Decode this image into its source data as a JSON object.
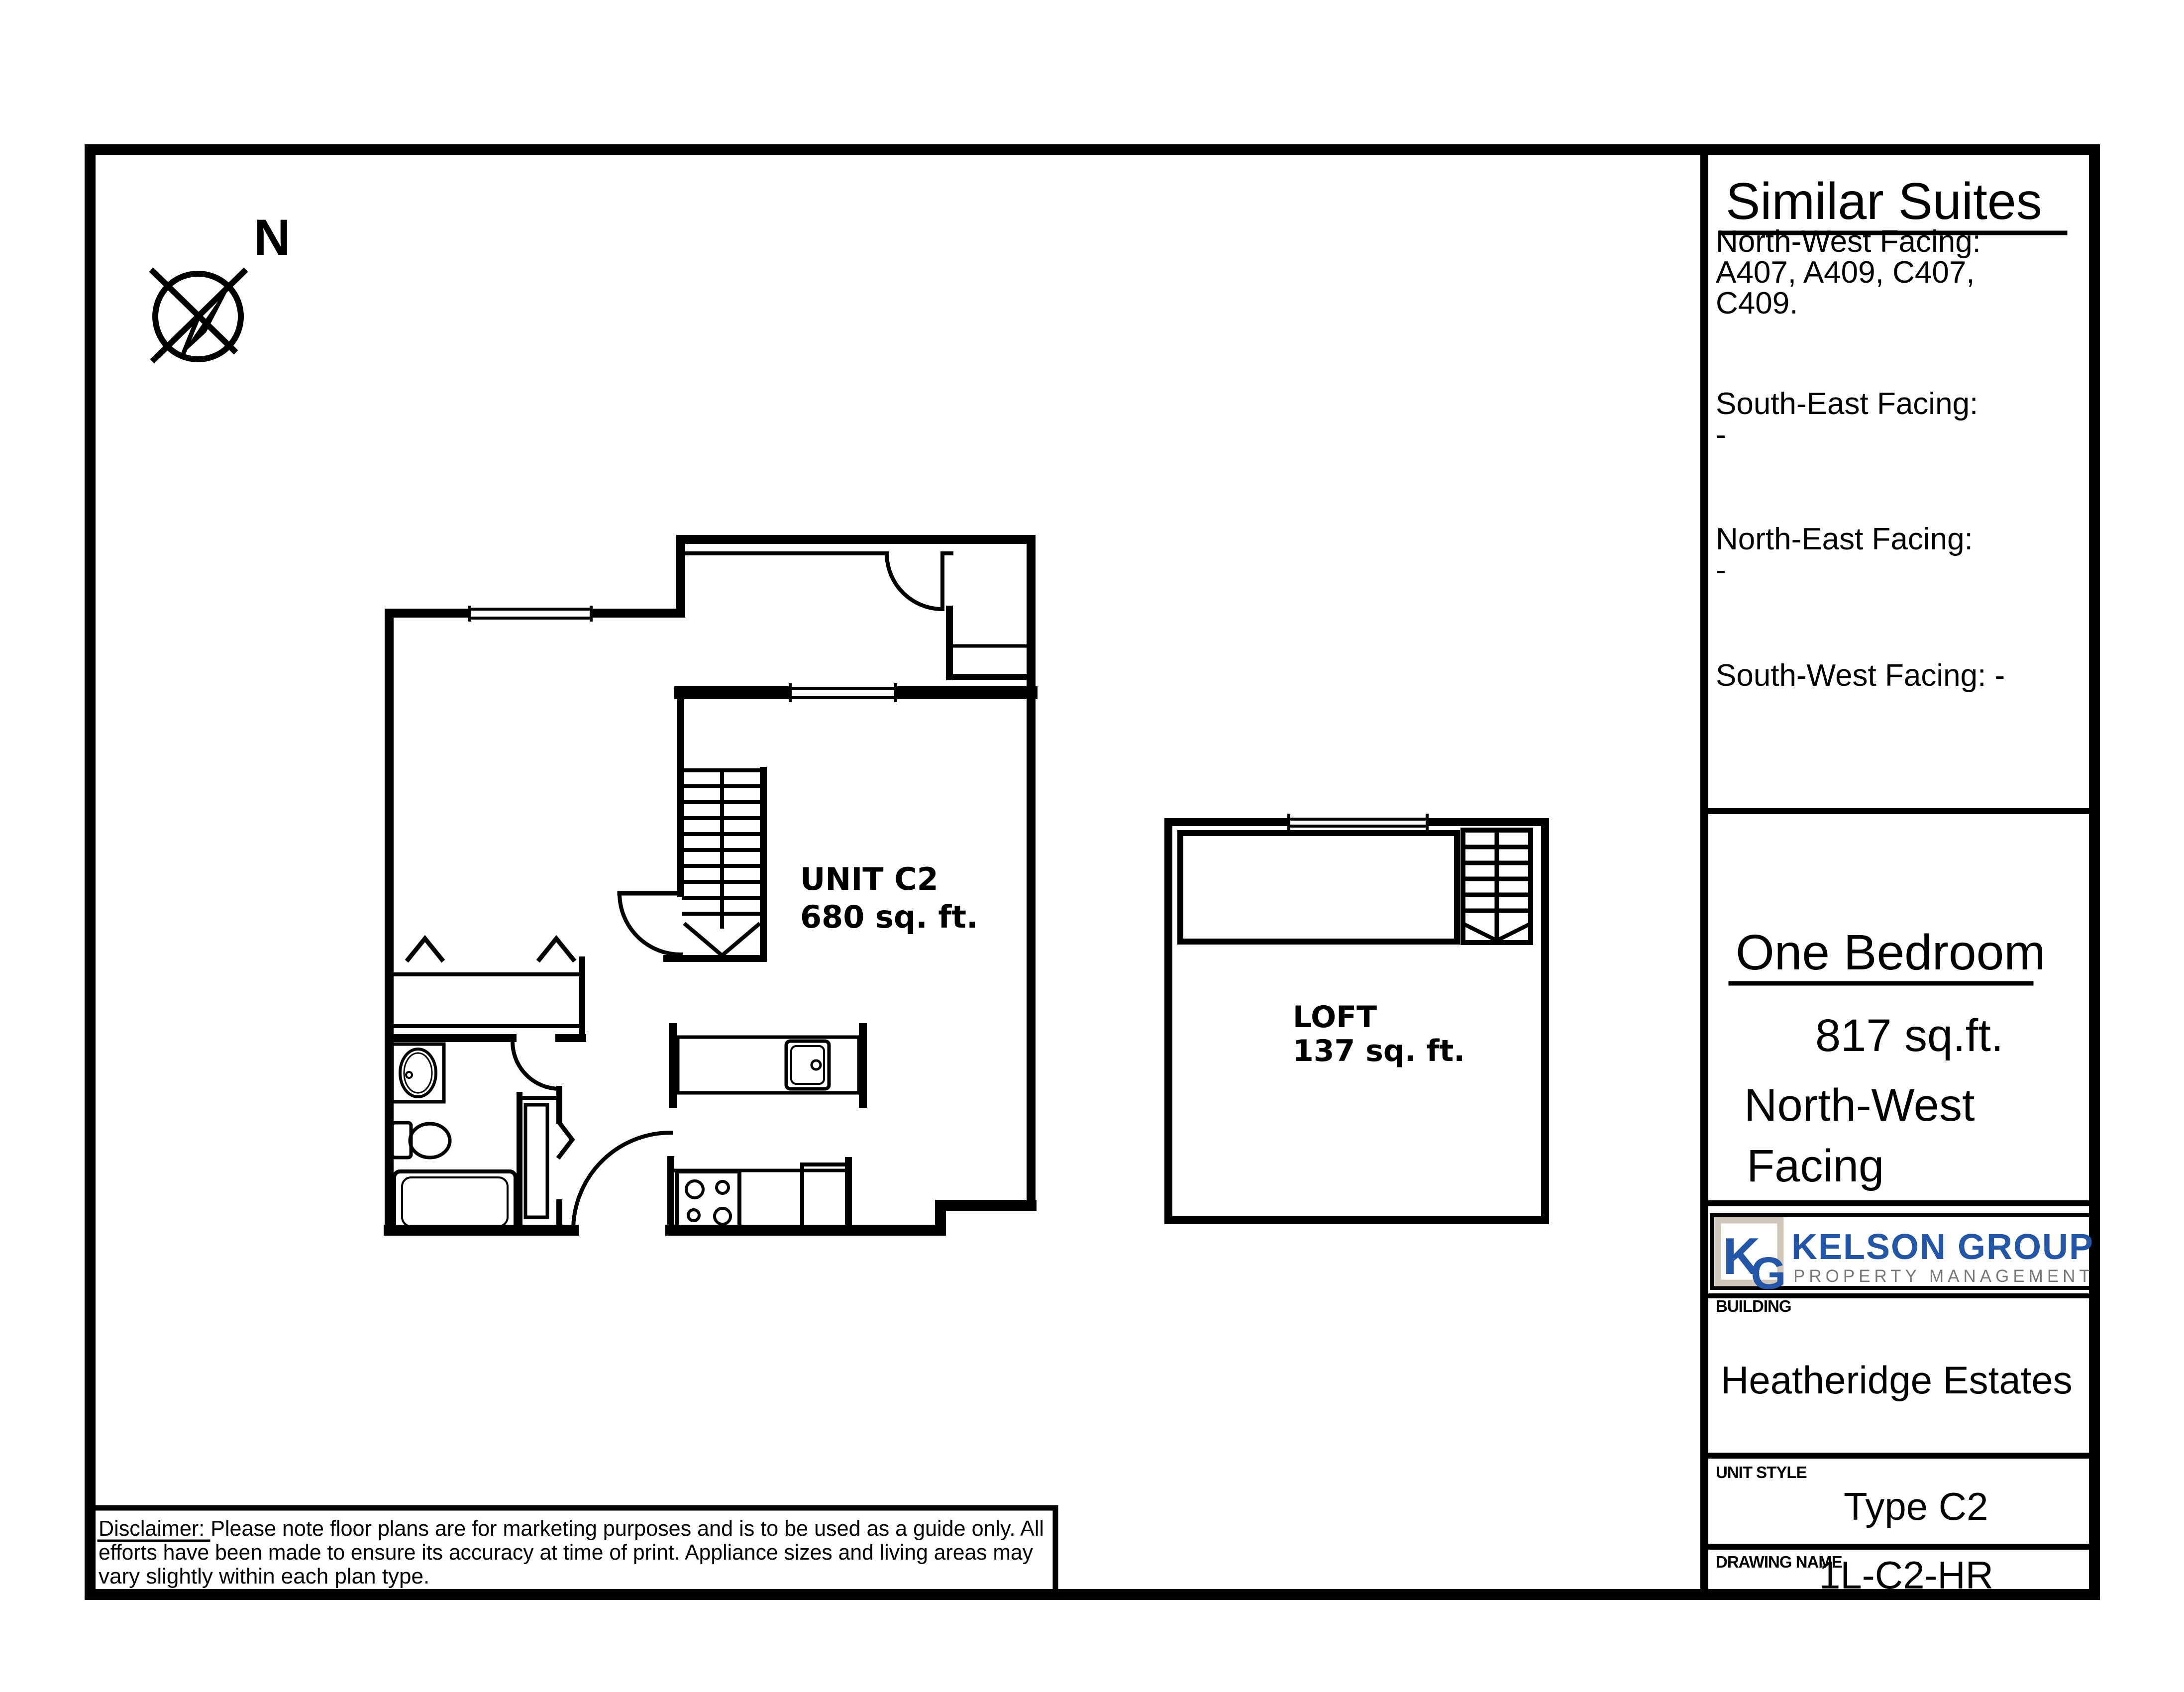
{
  "compass": {
    "north_label": "N"
  },
  "plan": {
    "unit_name": "UNIT C2",
    "unit_area": "680 sq. ft.",
    "loft_name": "LOFT",
    "loft_area": "137 sq. ft."
  },
  "similar_suites": {
    "title": "Similar Suites",
    "north_west_label": "North-West Facing:",
    "north_west_units_line1": "A407, A409, C407,",
    "north_west_units_line2": "C409.",
    "south_east_label": "South-East Facing:",
    "south_east_units": "-",
    "north_east_label": "North-East Facing:",
    "north_east_units": "-",
    "south_west_label": "South-West Facing: -"
  },
  "unit_summary": {
    "type": "One Bedroom",
    "area": "817 sq.ft.",
    "facing_line1": "North-West",
    "facing_line2": "Facing"
  },
  "logo": {
    "monogram_k": "K",
    "monogram_g": "G",
    "company": "KELSON GROUP",
    "tagline": "PROPERTY MANAGEMENT"
  },
  "title_block": {
    "building_label": "BUILDING",
    "building_value": "Heatheridge Estates",
    "unit_style_label": "UNIT STYLE",
    "unit_style_value": "Type C2",
    "drawing_name_label": "DRAWING NAME",
    "drawing_name_value": "1L-C2-HR"
  },
  "disclaimer": {
    "line1": "Disclaimer: Please note floor plans are for marketing purposes and is to be used as a guide only. All",
    "line2": "efforts have been made to ensure its accuracy at time of print. Appliance sizes and living areas may",
    "line3": "vary slightly within each plan type."
  },
  "colors": {
    "ink": "#000000",
    "brand_blue": "#2356a7",
    "brand_gray": "#77787b",
    "monogram_border": "#cfc8ba"
  }
}
